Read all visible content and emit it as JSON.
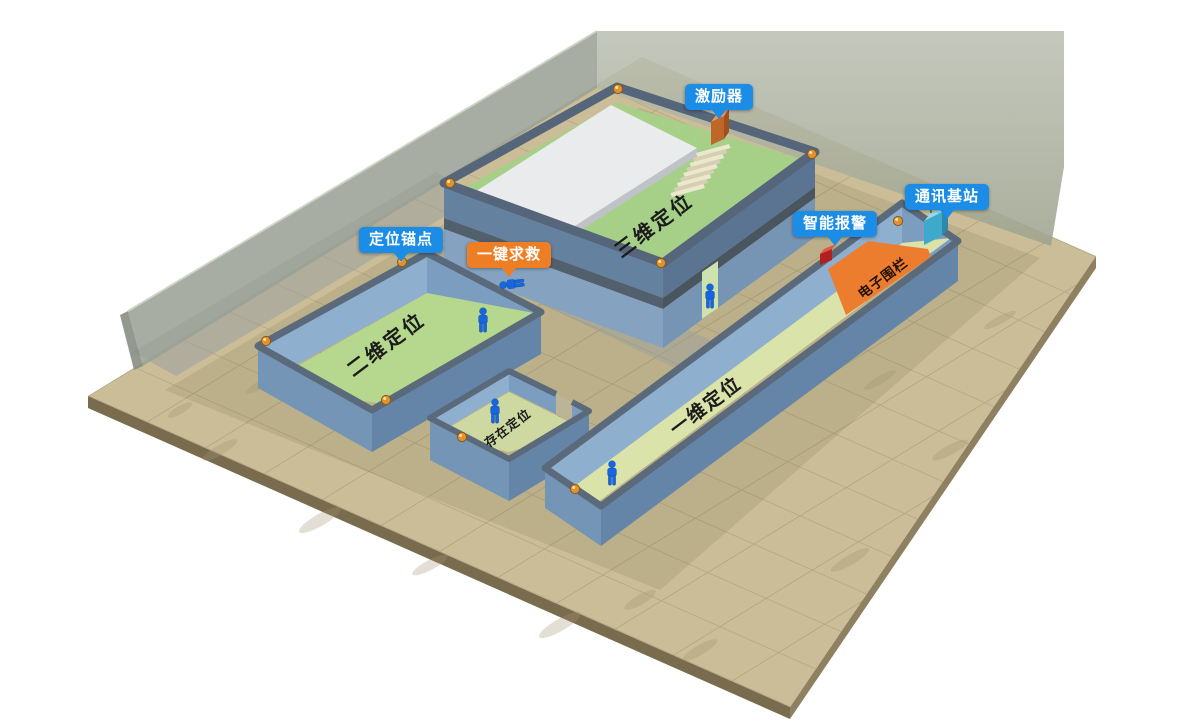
{
  "scene": {
    "callouts": [
      {
        "id": "exciter",
        "label": "激励器",
        "color": "#1c8de6"
      },
      {
        "id": "comm_base",
        "label": "通讯基站",
        "color": "#1c8de6"
      },
      {
        "id": "smart_alarm",
        "label": "智能报警",
        "color": "#1c8de6"
      },
      {
        "id": "anchor_point",
        "label": "定位锚点",
        "color": "#1c8de6"
      },
      {
        "id": "sos",
        "label": "一键求救",
        "color": "#ee7e23"
      }
    ],
    "areas": [
      {
        "id": "area_3d",
        "label": "三维定位"
      },
      {
        "id": "area_2d",
        "label": "二维定位"
      },
      {
        "id": "area_presence",
        "label": "存在定位"
      },
      {
        "id": "area_1d",
        "label": "一维定位"
      },
      {
        "id": "fence",
        "label": "电子围栏"
      }
    ],
    "colors": {
      "callout_blue": "#1c8de6",
      "callout_orange": "#ee7e23",
      "fence_orange": "#ed7d2e",
      "floor_tan": "#cabd97",
      "room_green": "#b5d78e",
      "corridor_green": "#d9e3aa",
      "building_green": "#a6cf88",
      "upper_floor_white": "#e9ebec",
      "wall_blue_outer": "#7495b6",
      "wall_rim_slate": "#5a6a7a",
      "back_wall_grey": "#aab0a4",
      "person_blue": "#1766dd",
      "anchor_orange": "#e2912f"
    }
  }
}
